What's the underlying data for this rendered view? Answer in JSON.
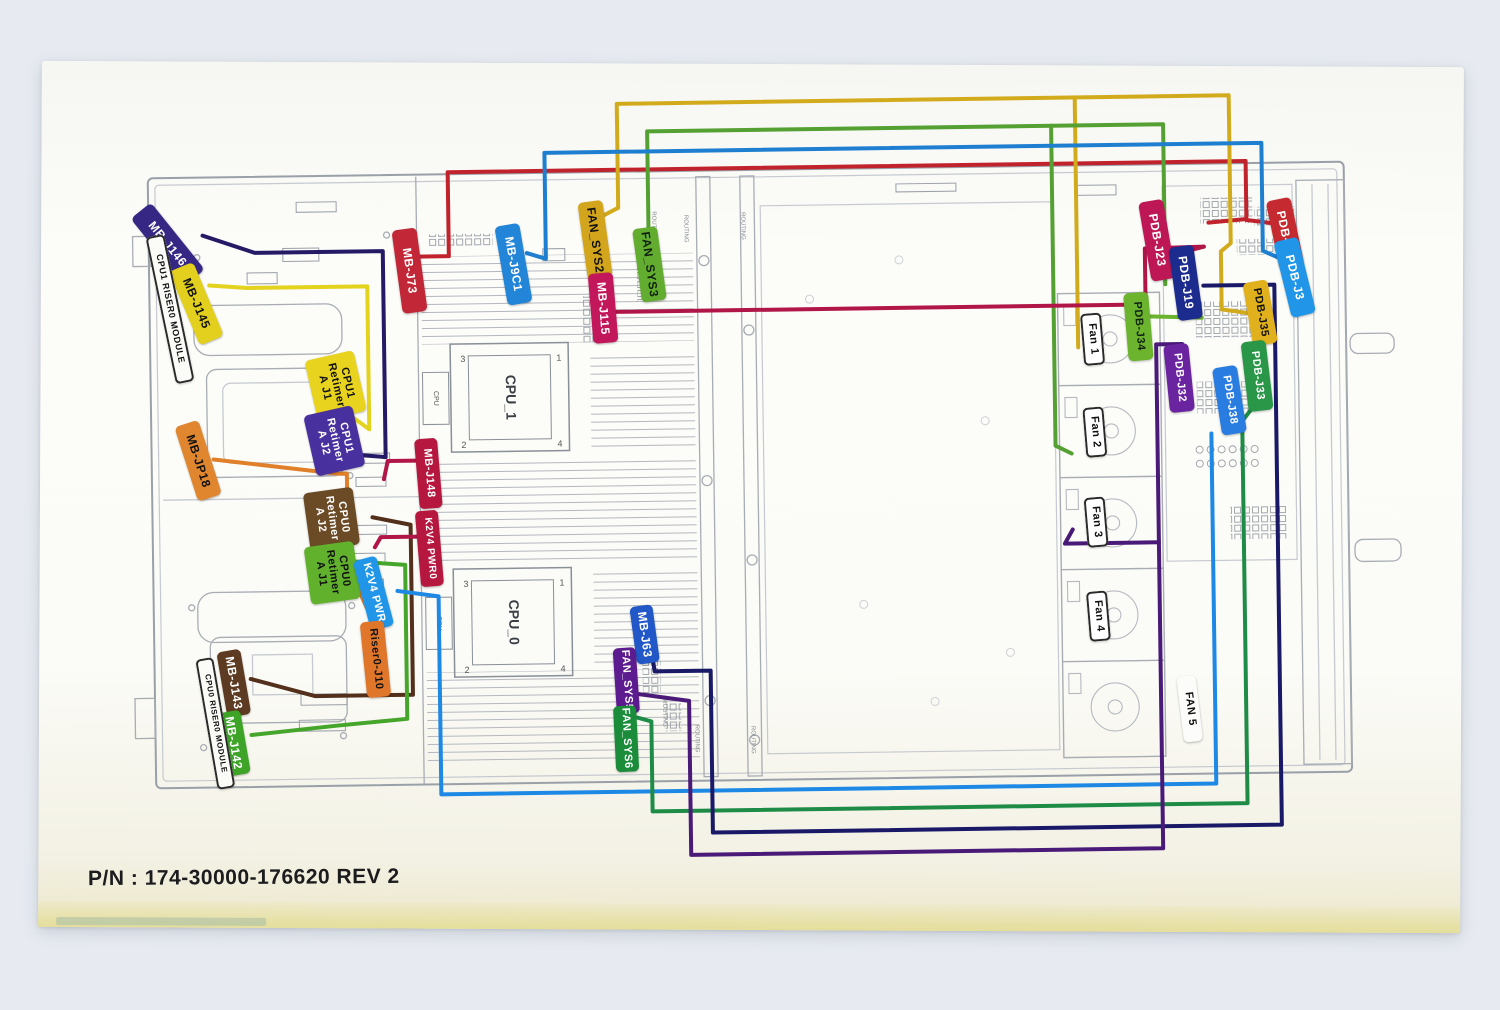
{
  "footer": {
    "part_number": "P/N : 174-30000-176620 REV 2"
  },
  "drawing": {
    "cpu1_label": "CPU_1",
    "cpu0_label": "CPU_0",
    "cpu_small": "CPU",
    "routing_note": "ROUTING",
    "pins": {
      "p1": "1",
      "p2": "2",
      "p3": "3",
      "p4": "4"
    }
  },
  "colors": {
    "paper": "#fbfbf7",
    "background": "#e7ebf1",
    "line_art": "#a8adb4",
    "wire_red": "#c0232c",
    "wire_yellow": "#d2ab1c",
    "wire_green_top": "#55a033",
    "wire_blue_top": "#1e7fd0",
    "wire_crimson": "#b01648",
    "wire_indigo": "#241a66",
    "wire_orange": "#e0802a",
    "wire_brown": "#53301b",
    "wire_lightblue": "#1e88e5",
    "wire_green_bottom": "#1e8c46",
    "wire_navy": "#191968",
    "wire_purple": "#4a1a78"
  },
  "labels": [
    {
      "id": "mb-j146",
      "text": "MB-J146",
      "x": 158,
      "y": 193,
      "w": 26,
      "h": 86,
      "rot": -38,
      "bg": "#372785",
      "fg": "#ffffff"
    },
    {
      "id": "mb-j145",
      "text": "MB-J145",
      "x": 186,
      "y": 256,
      "w": 26,
      "h": 80,
      "rot": -22,
      "bg": "#e3cf1d",
      "fg": "#111111"
    },
    {
      "id": "cpu1-riser-module",
      "text": "CPU1 RISER0 MODULE",
      "x": 163,
      "y": 226,
      "w": 19,
      "h": 150,
      "rot": -11,
      "bg": "#fbfbf8",
      "fg": "#111111",
      "border": true,
      "fs": 9
    },
    {
      "id": "mb-j73",
      "text": "MB-J73",
      "x": 400,
      "y": 224,
      "w": 25,
      "h": 84,
      "rot": -7,
      "bg": "#c22737",
      "fg": "#ffffff"
    },
    {
      "id": "mb-j9c1",
      "text": "MB-J9C1",
      "x": 504,
      "y": 221,
      "w": 25,
      "h": 80,
      "rot": -9,
      "bg": "#2285d8",
      "fg": "#ffffff"
    },
    {
      "id": "fan-sys2",
      "text": "FAN_SYS2",
      "x": 586,
      "y": 199,
      "w": 25,
      "h": 78,
      "rot": -7,
      "bg": "#d2a51c",
      "fg": "#111111"
    },
    {
      "id": "fan-sys3",
      "text": "FAN_SYS3",
      "x": 640,
      "y": 226,
      "w": 25,
      "h": 74,
      "rot": -7,
      "bg": "#62ad30",
      "fg": "#112211"
    },
    {
      "id": "mb-j115",
      "text": "MB-J115",
      "x": 593,
      "y": 271,
      "w": 25,
      "h": 70,
      "rot": -4,
      "bg": "#c2175b",
      "fg": "#ffffff"
    },
    {
      "id": "cpu1-retimer-a-j1",
      "text": "CPU1\nRetimer\nA J1",
      "x": 312,
      "y": 349,
      "w": 50,
      "h": 62,
      "rot": -12,
      "bg": "#e8d31f",
      "fg": "#111111",
      "fs": 11
    },
    {
      "id": "cpu1-retimer-a-j2",
      "text": "CPU1\nRetimer\nA J2",
      "x": 310,
      "y": 404,
      "w": 50,
      "h": 62,
      "rot": -12,
      "bg": "#48309e",
      "fg": "#ffffff",
      "fs": 11
    },
    {
      "id": "mb-jp18",
      "text": "MB-JP18",
      "x": 186,
      "y": 414,
      "w": 25,
      "h": 78,
      "rot": -17,
      "bg": "#e0862f",
      "fg": "#111111"
    },
    {
      "id": "cpu0-retimer-a-j2",
      "text": "CPU0\nRetimer\nA J2",
      "x": 306,
      "y": 484,
      "w": 50,
      "h": 58,
      "rot": -7,
      "bg": "#6b4a26",
      "fg": "#ffffff",
      "fs": 11
    },
    {
      "id": "cpu0-retimer-a-j1",
      "text": "CPU0\nRetimer\nA J1",
      "x": 306,
      "y": 538,
      "w": 50,
      "h": 58,
      "rot": -7,
      "bg": "#62b12d",
      "fg": "#111111",
      "fs": 11
    },
    {
      "id": "k2v4-pwr",
      "text": "K2V4 PWR",
      "x": 360,
      "y": 552,
      "w": 24,
      "h": 72,
      "rot": -14,
      "bg": "#2196e8",
      "fg": "#ffffff",
      "fs": 11
    },
    {
      "id": "riser0-j10",
      "text": "Riser0-J10",
      "x": 361,
      "y": 616,
      "w": 24,
      "h": 76,
      "rot": -5,
      "bg": "#e0762a",
      "fg": "#111111",
      "fs": 11
    },
    {
      "id": "mb-j148",
      "text": "MB-J148",
      "x": 417,
      "y": 434,
      "w": 23,
      "h": 70,
      "rot": -4,
      "bg": "#b5173f",
      "fg": "#ffffff",
      "fs": 11
    },
    {
      "id": "k2v4-pwr0",
      "text": "K2V4 PWR0",
      "x": 417,
      "y": 506,
      "w": 23,
      "h": 76,
      "rot": -4,
      "bg": "#b5173f",
      "fg": "#ffffff",
      "fs": 10
    },
    {
      "id": "mb-j143",
      "text": "MB-J143",
      "x": 219,
      "y": 643,
      "w": 24,
      "h": 66,
      "rot": -9,
      "bg": "#5d3a22",
      "fg": "#ffffff"
    },
    {
      "id": "mb-j142",
      "text": "MB-J142",
      "x": 218,
      "y": 704,
      "w": 24,
      "h": 64,
      "rot": -9,
      "bg": "#3da428",
      "fg": "#ffffff"
    },
    {
      "id": "cpu0-riser-module",
      "text": "CPU0 RISER0 MODULE",
      "x": 203,
      "y": 650,
      "w": 18,
      "h": 132,
      "rot": -9,
      "bg": "#fbfbf8",
      "fg": "#111111",
      "border": true,
      "fs": 8
    },
    {
      "id": "mb-j63",
      "text": "MB-J63",
      "x": 631,
      "y": 604,
      "w": 23,
      "h": 58,
      "rot": -7,
      "bg": "#2257c8",
      "fg": "#ffffff"
    },
    {
      "id": "fan-sys5",
      "text": "FAN_SYS5",
      "x": 612,
      "y": 646,
      "w": 23,
      "h": 66,
      "rot": -3,
      "bg": "#5c1b8e",
      "fg": "#ffffff",
      "fs": 11
    },
    {
      "id": "fan-sys6",
      "text": "FAN_SYS6",
      "x": 611,
      "y": 704,
      "w": 23,
      "h": 66,
      "rot": -2,
      "bg": "#1a8c3a",
      "fg": "#ffffff",
      "fs": 11
    },
    {
      "id": "fan-1",
      "text": "Fan 1",
      "x": 1084,
      "y": 318,
      "w": 21,
      "h": 52,
      "rot": -4,
      "bg": "#ffffff",
      "fg": "#111111",
      "border": true,
      "fs": 11
    },
    {
      "id": "fan-2",
      "text": "Fan 2",
      "x": 1085,
      "y": 412,
      "w": 21,
      "h": 50,
      "rot": -4,
      "bg": "#ffffff",
      "fg": "#111111",
      "border": true,
      "fs": 11
    },
    {
      "id": "fan-3",
      "text": "Fan 3",
      "x": 1085,
      "y": 502,
      "w": 21,
      "h": 50,
      "rot": -4,
      "bg": "#ffffff",
      "fg": "#111111",
      "border": true,
      "fs": 11
    },
    {
      "id": "fan-4",
      "text": "Fan 4",
      "x": 1086,
      "y": 596,
      "w": 21,
      "h": 50,
      "rot": -4,
      "bg": "#ffffff",
      "fg": "#111111",
      "border": true,
      "fs": 11
    },
    {
      "id": "fan-5",
      "text": "FAN 5",
      "x": 1177,
      "y": 682,
      "w": 19,
      "h": 66,
      "rot": -6,
      "bg": "#fcfcfa",
      "fg": "#111111",
      "fs": 11
    },
    {
      "id": "pdb-j23",
      "text": "PDB-J23",
      "x": 1148,
      "y": 206,
      "w": 25,
      "h": 80,
      "rot": -9,
      "bg": "#bd1855",
      "fg": "#ffffff"
    },
    {
      "id": "pdb-j5",
      "text": "PDB-J5",
      "x": 1276,
      "y": 206,
      "w": 25,
      "h": 70,
      "rot": -11,
      "bg": "#c62a31",
      "fg": "#ffffff"
    },
    {
      "id": "pdb-j3",
      "text": "PDB-J3",
      "x": 1285,
      "y": 246,
      "w": 25,
      "h": 78,
      "rot": -13,
      "bg": "#2196e8",
      "fg": "#ffffff"
    },
    {
      "id": "pdb-j19",
      "text": "PDB-J19",
      "x": 1176,
      "y": 252,
      "w": 25,
      "h": 74,
      "rot": -7,
      "bg": "#1b2b8e",
      "fg": "#ffffff"
    },
    {
      "id": "pdb-j35",
      "text": "PDB-J35",
      "x": 1250,
      "y": 288,
      "w": 25,
      "h": 64,
      "rot": -9,
      "bg": "#e0b01d",
      "fg": "#111111",
      "fs": 11
    },
    {
      "id": "pdb-j34",
      "text": "PDB-J34",
      "x": 1128,
      "y": 298,
      "w": 25,
      "h": 68,
      "rot": -4,
      "bg": "#6cb32e",
      "fg": "#112211",
      "fs": 11
    },
    {
      "id": "pdb-j32",
      "text": "PDB-J32",
      "x": 1168,
      "y": 350,
      "w": 25,
      "h": 68,
      "rot": -5,
      "bg": "#6a24a0",
      "fg": "#ffffff",
      "fs": 11
    },
    {
      "id": "pdb-j33",
      "text": "PDB-J33",
      "x": 1246,
      "y": 348,
      "w": 25,
      "h": 70,
      "rot": -6,
      "bg": "#2a9648",
      "fg": "#ffffff",
      "fs": 11
    },
    {
      "id": "pdb-j38",
      "text": "PDB-J38",
      "x": 1218,
      "y": 373,
      "w": 25,
      "h": 68,
      "rot": -8,
      "bg": "#2a7de0",
      "fg": "#ffffff",
      "fs": 11
    }
  ],
  "wires": [
    {
      "id": "mb-j73-to-pdb-j5",
      "color": "#c0232c",
      "pts": "420,252 452,252 452,168 1250,168 1250,226 1212,229"
    },
    {
      "id": "pdb-j5-leader",
      "color": "#c0232c",
      "pts": "1280,231 1250,227"
    },
    {
      "id": "fan-sys2-to-pdb-j35",
      "color": "#d2ab1c",
      "pts": "606,214 622,206 622,102 1234,102 1234,250 1224,258 1224,316 1250,320"
    },
    {
      "id": "fan-sys2-branch-fan1",
      "color": "#d2ab1c",
      "pts": "1080,102 1080,352"
    },
    {
      "id": "fan-sys3-to-pdb-j34",
      "color": "#55a033",
      "pts": "652,232 652,130 1168,130 1168,290"
    },
    {
      "id": "fan-sys3-branch-fan2",
      "color": "#55a033",
      "pts": "1056,130 1056,450 1072,458"
    },
    {
      "id": "mb-j9c1-to-pdb-j3",
      "color": "#1e7fd0",
      "pts": "530,250 549,256 549,150 1266,150 1266,258 1288,268"
    },
    {
      "id": "mb-j115-to-pdb-j23",
      "color": "#b01648",
      "pts": "617,310 1148,310 1148,254 1207,253"
    },
    {
      "id": "pdb-j23-leader",
      "color": "#b01648",
      "pts": "1170,262 1207,253"
    },
    {
      "id": "mb-j146-to-cpu1-retimer-j2",
      "color": "#241a66",
      "pts": "206,228 258,246 386,246 386,452 364,450"
    },
    {
      "id": "mb-j145-to-cpu1-retimer-j1",
      "color": "#e3d21e",
      "pts": "212,278 250,281 370,281 370,424 354,412"
    },
    {
      "id": "mb-jp18-to-riser0-j10",
      "color": "#e0802a",
      "pts": "214,452 338,468 347,468 347,560 362,576"
    },
    {
      "id": "riser0-j10-leader",
      "color": "#e0802a",
      "pts": "372,618 356,582 348,562"
    },
    {
      "id": "mb-j143-to-cpu0-retimer-j2",
      "color": "#53301b",
      "pts": "248,672 312,690 410,690 410,520 372,512"
    },
    {
      "id": "mb-j142-to-cpu0-retimer-j1",
      "color": "#46a52b",
      "pts": "354,556 404,560 404,714 332,720 248,728"
    },
    {
      "id": "mb-j148-stub",
      "color": "#b01648",
      "pts": "418,456 388,456 384,474"
    },
    {
      "id": "k2v4-pwr0-stub",
      "color": "#b01648",
      "pts": "418,532 380,532 374,542"
    },
    {
      "id": "k2v4-pwr-to-pdb-j38",
      "color": "#1e88e5",
      "pts": "396,586 437,592 437,790 1212,790 1212,440"
    },
    {
      "id": "fan-sys6-to-pdb-j33",
      "color": "#1e8c46",
      "pts": "634,716 648,720 648,810 1243,810 1243,428 1254,414"
    },
    {
      "id": "mb-j63-to-pdb-j19",
      "color": "#191968",
      "pts": "650,656 652,670 708,670 708,832 1277,832 1277,292 1206,292"
    },
    {
      "id": "fan-sys5-to-pdb-j32",
      "color": "#4a1a78",
      "pts": "632,692 686,700 686,854 1158,854 1158,350 1184,350"
    },
    {
      "id": "fan-sys5-branch-fan3",
      "color": "#4a1a78",
      "pts": "1158,548 1064,548 1072,534"
    },
    {
      "id": "pdb-j34-leader",
      "color": "#6cb32e",
      "pts": "1150,322 1204,324"
    }
  ]
}
